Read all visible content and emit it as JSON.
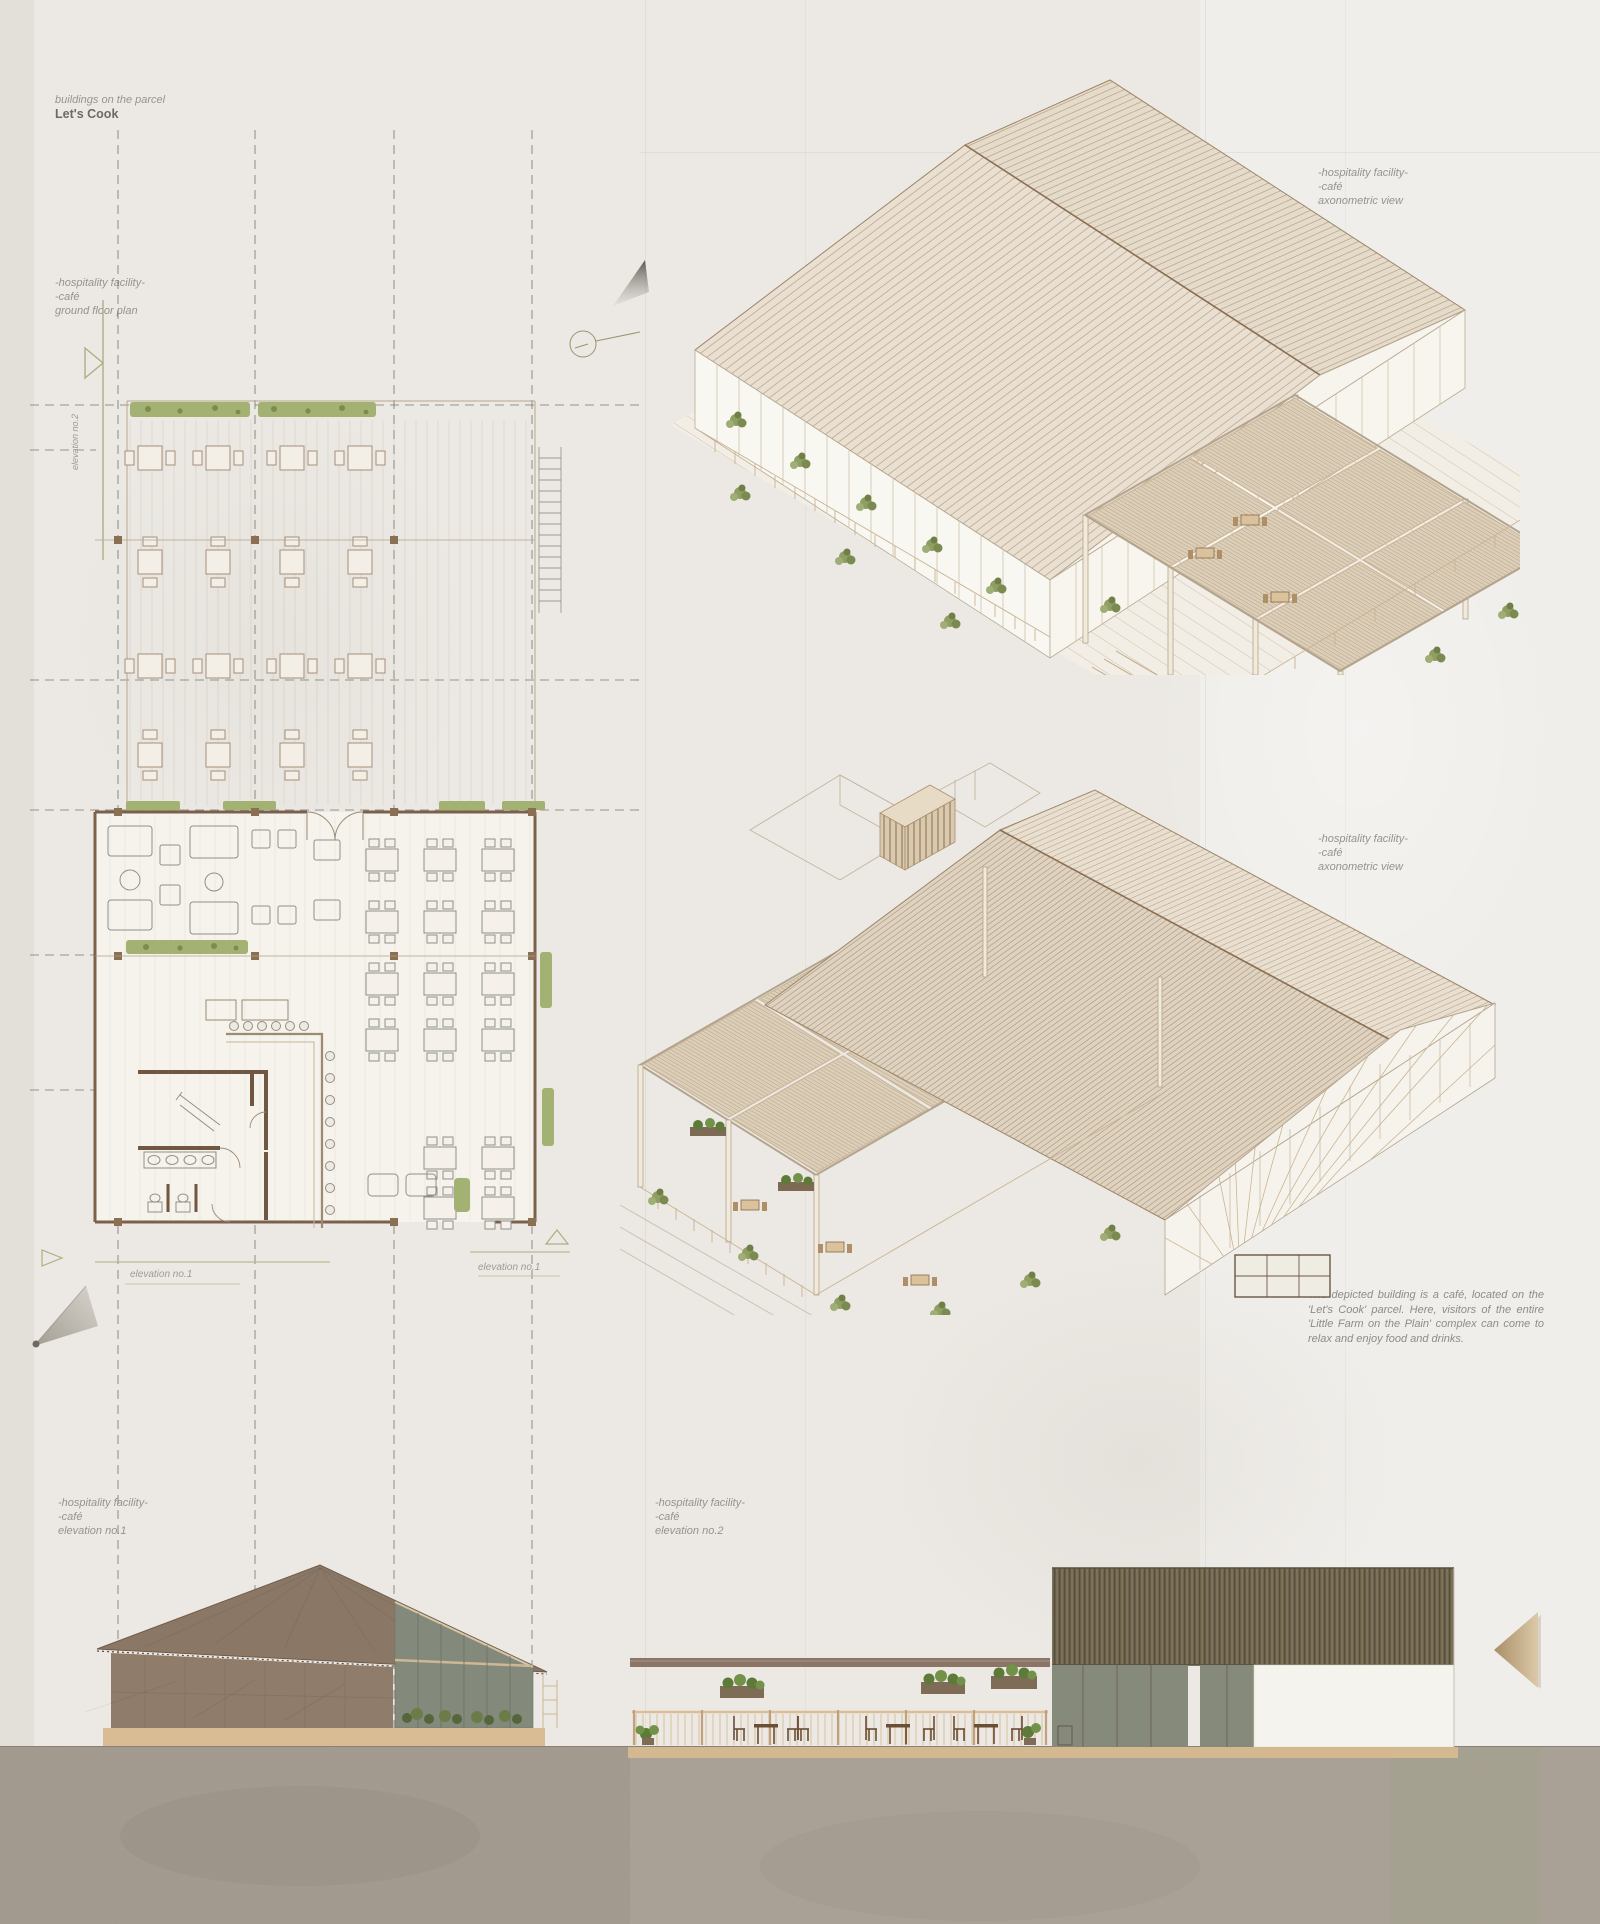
{
  "header": {
    "note": "buildings on the parcel",
    "title": "Let's Cook"
  },
  "labels": {
    "plan": {
      "line1": "-hospitality facility-",
      "line2": "-café",
      "line3": "ground floor plan"
    },
    "axon_top": {
      "line1": "-hospitality facility-",
      "line2": "-café",
      "line3": "axonometric view"
    },
    "axon_middle": {
      "line1": "-hospitality facility-",
      "line2": "-café",
      "line3": "axonometric view"
    },
    "elevation1": {
      "line1": "-hospitality facility-",
      "line2": "-café",
      "line3": "elevation no.1"
    },
    "elevation2": {
      "line1": "-hospitality facility-",
      "line2": "-café",
      "line3": "elevation no.2"
    }
  },
  "plan_annotations": {
    "marker_bottom_left": "elevation no.1",
    "marker_bottom_right": "elevation no.1",
    "marker_side": "elevation no.2"
  },
  "description": "The depicted building is a café, located on the 'Let's Cook' parcel. Here, visitors of the entire 'Little Farm on the Plain' complex can come to relax and enjoy food and drinks.",
  "palette": {
    "paper": "#ece9e4",
    "ink_gray": "#96938d",
    "wall_brown": "#7b614b",
    "roof_hatch_tan": "#b59b7f",
    "roof_brown": "#8d7a68",
    "glass_green": "#848a7b",
    "plant_green": "#a3b173",
    "slat_olive": "#7d7258",
    "base_tan": "#d7ba92",
    "ground": "#a69d92",
    "marker_olive": "#a9b184"
  }
}
